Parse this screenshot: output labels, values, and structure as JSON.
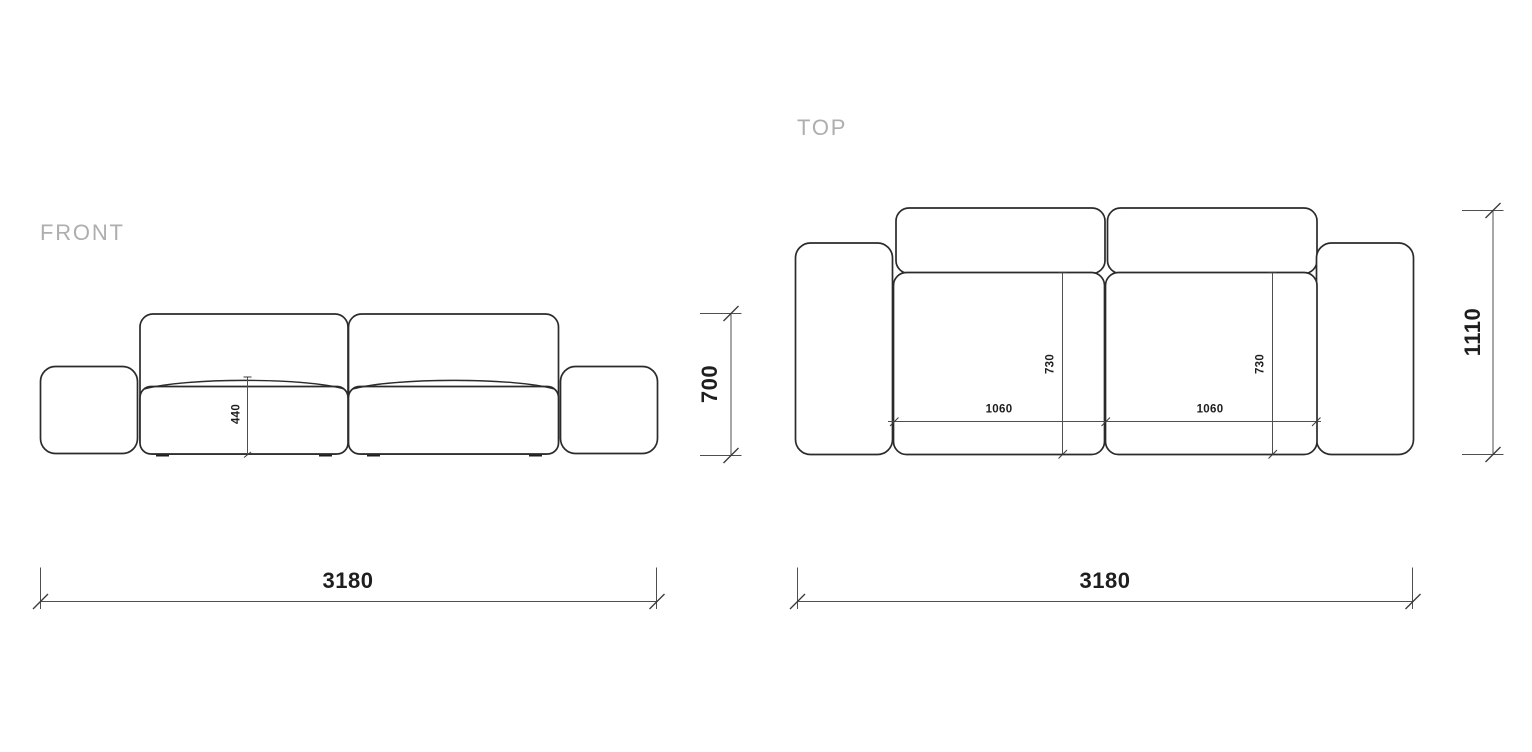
{
  "document": {
    "type": "sofa-technical-drawing",
    "background_color": "#ffffff",
    "outline_color": "#2b2b2b",
    "dimension_line_color": "#4f4f4f",
    "dimension_text_color": "#1e1e1e",
    "view_label_color": "#aeaeae"
  },
  "front_view": {
    "label": "FRONT",
    "dimensions": {
      "overall_width": "3180",
      "overall_height": "700",
      "seat_height": "440"
    }
  },
  "top_view": {
    "label": "TOP",
    "dimensions": {
      "overall_width": "3180",
      "overall_depth": "1110",
      "seat_module_width_left": "1060",
      "seat_module_width_right": "1060",
      "seat_depth_left": "730",
      "seat_depth_right": "730"
    }
  }
}
